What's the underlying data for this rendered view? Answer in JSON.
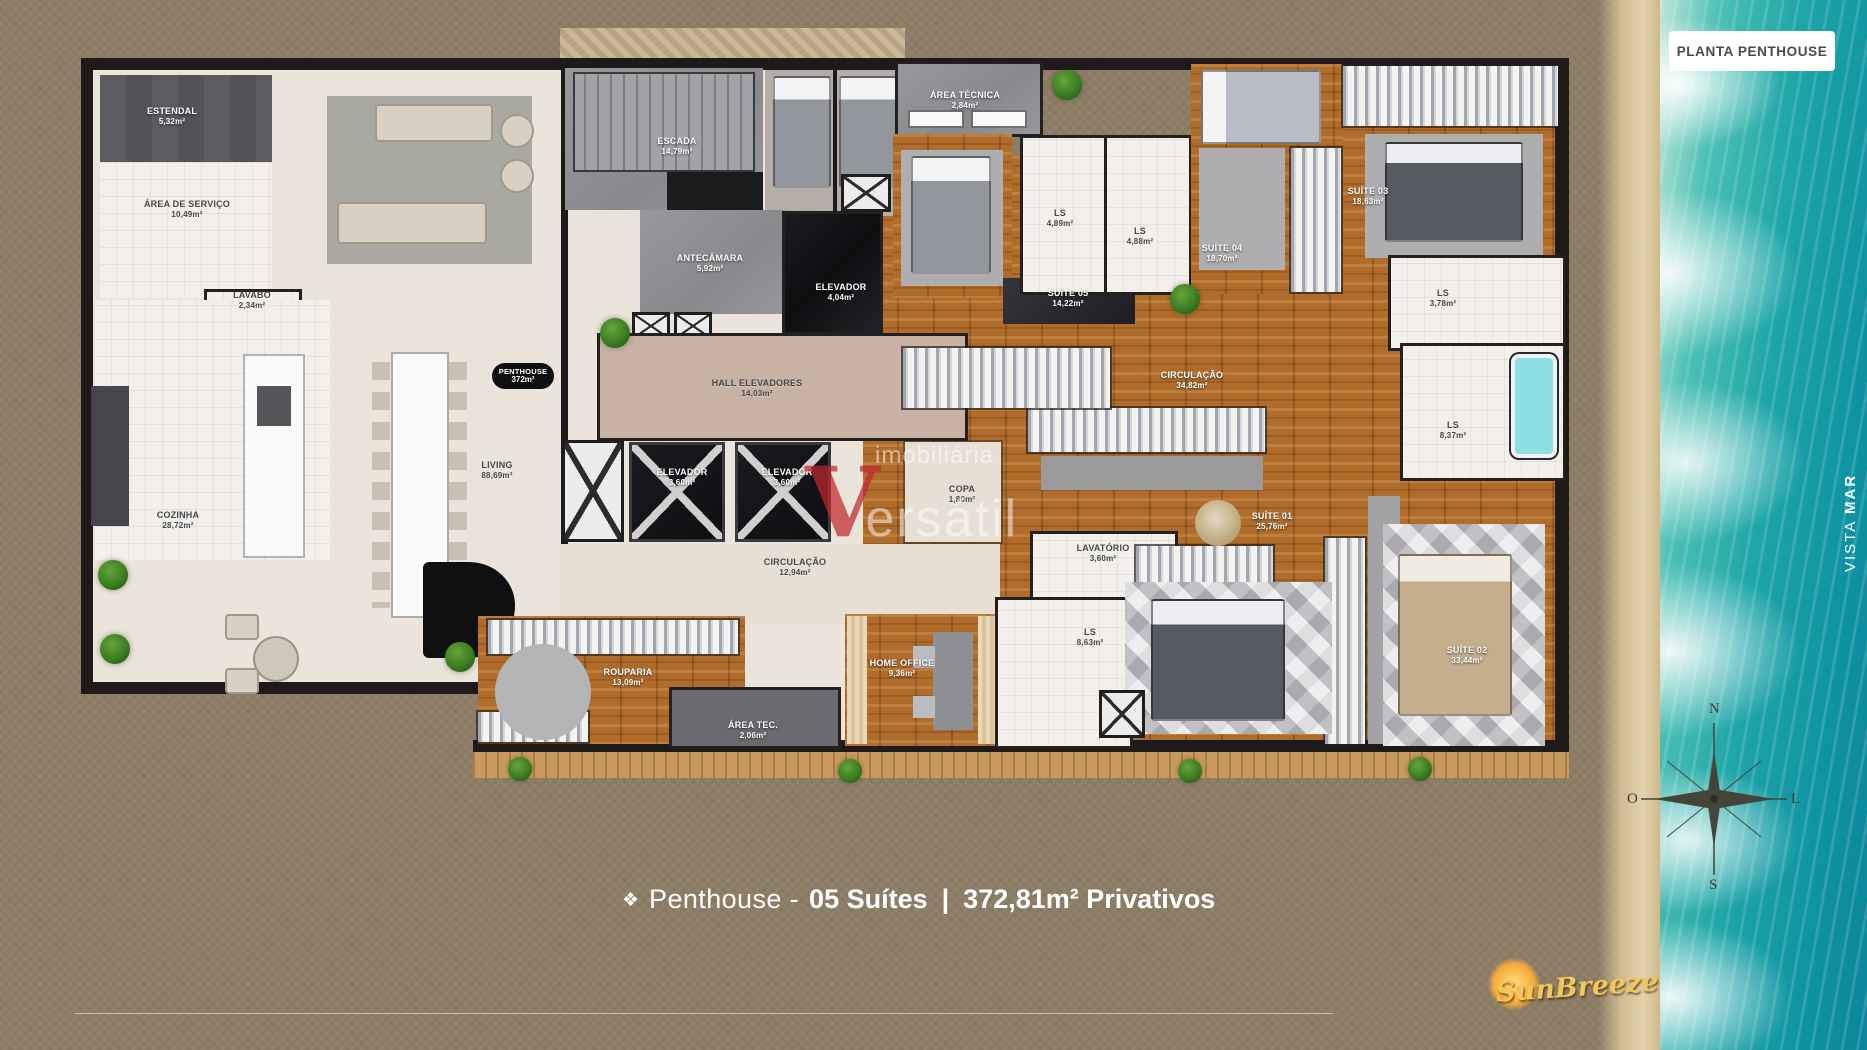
{
  "top_badge": {
    "label": "PLANTA PENTHOUSE"
  },
  "vista_mar": {
    "word1": "VISTA",
    "word2": "MAR",
    "color": "#0f9d99"
  },
  "caption": {
    "icon": "❖",
    "prefix": "Penthouse -",
    "suites": "05 Suítes",
    "separator": "|",
    "privative": "372,81m² Privativos"
  },
  "compass": {
    "north": "N",
    "south": "S",
    "west": "O",
    "east": "L"
  },
  "watermark": {
    "top": "imobiliária",
    "initial": "V",
    "rest": "ersátil"
  },
  "logo": {
    "text": "SunBreeze"
  },
  "colors": {
    "accent_teal": "#0f9d99",
    "background_brown": "#8d7d67",
    "wood_floor": "#b06c2b",
    "wall": "#1d1a19",
    "watermark_red": "#c1272d",
    "logo_gold": "#f2c75a"
  },
  "plan": {
    "overlay_badge": {
      "name": "PENTHOUSE",
      "area": "372m²"
    },
    "rooms": [
      {
        "name": "ESTENDAL",
        "area": "5,32m²",
        "x": 172,
        "y": 116,
        "tone": "light"
      },
      {
        "name": "ÁREA DE SERVIÇO",
        "area": "10,49m²",
        "x": 187,
        "y": 209,
        "tone": "dark"
      },
      {
        "name": "LAVABO",
        "area": "2,34m²",
        "x": 252,
        "y": 300,
        "tone": "dark"
      },
      {
        "name": "COZINHA",
        "area": "28,72m²",
        "x": 178,
        "y": 520,
        "tone": "dark"
      },
      {
        "name": "LIVING",
        "area": "88,69m²",
        "x": 497,
        "y": 470,
        "tone": "dark"
      },
      {
        "name": "ESCADA",
        "area": "14,79m²",
        "x": 677,
        "y": 146,
        "tone": "light"
      },
      {
        "name": "ANTECÂMARA",
        "area": "5,92m²",
        "x": 710,
        "y": 263,
        "tone": "light"
      },
      {
        "name": "ELEVADOR",
        "area": "4,04m²",
        "x": 841,
        "y": 292,
        "tone": "light"
      },
      {
        "name": "HALL ELEVADORES",
        "area": "14,03m²",
        "x": 757,
        "y": 388,
        "tone": "dark"
      },
      {
        "name": "ELEVADOR",
        "area": "3,60m²",
        "x": 682,
        "y": 477,
        "tone": "light"
      },
      {
        "name": "ELEVADOR",
        "area": "3,60m²",
        "x": 787,
        "y": 477,
        "tone": "light"
      },
      {
        "name": "CIRCULAÇÃO",
        "area": "12,94m²",
        "x": 795,
        "y": 567,
        "tone": "dark"
      },
      {
        "name": "ROUPARIA",
        "area": "13,09m²",
        "x": 628,
        "y": 677,
        "tone": "light"
      },
      {
        "name": "ÁREA TEC.",
        "area": "2,06m²",
        "x": 753,
        "y": 730,
        "tone": "light"
      },
      {
        "name": "HOME OFFICE",
        "area": "9,36m²",
        "x": 902,
        "y": 668,
        "tone": "light"
      },
      {
        "name": "COPA",
        "area": "1,80m²",
        "x": 962,
        "y": 494,
        "tone": "dark"
      },
      {
        "name": "LAVATÓRIO",
        "area": "3,60m²",
        "x": 1103,
        "y": 553,
        "tone": "dark"
      },
      {
        "name": "LS",
        "area": "8,63m²",
        "x": 1090,
        "y": 637,
        "tone": "dark"
      },
      {
        "name": "ÁREA TÉCNICA",
        "area": "2,84m²",
        "x": 965,
        "y": 100,
        "tone": "light"
      },
      {
        "name": "SUÍTE 05",
        "area": "14,22m²",
        "x": 1068,
        "y": 298,
        "tone": "light"
      },
      {
        "name": "LS",
        "area": "4,89m²",
        "x": 1060,
        "y": 218,
        "tone": "dark"
      },
      {
        "name": "LS",
        "area": "4,88m²",
        "x": 1140,
        "y": 236,
        "tone": "dark"
      },
      {
        "name": "SUÍTE 04",
        "area": "18,70m²",
        "x": 1222,
        "y": 253,
        "tone": "light"
      },
      {
        "name": "CIRCULAÇÃO",
        "area": "34,82m²",
        "x": 1192,
        "y": 380,
        "tone": "light"
      },
      {
        "name": "SUÍTE 03",
        "area": "18,63m²",
        "x": 1368,
        "y": 196,
        "tone": "light"
      },
      {
        "name": "LS",
        "area": "3,78m²",
        "x": 1443,
        "y": 298,
        "tone": "dark"
      },
      {
        "name": "LS",
        "area": "8,37m²",
        "x": 1453,
        "y": 430,
        "tone": "dark"
      },
      {
        "name": "SUÍTE 01",
        "area": "25,76m²",
        "x": 1272,
        "y": 521,
        "tone": "light"
      },
      {
        "name": "SUÍTE 02",
        "area": "33,44m²",
        "x": 1467,
        "y": 655,
        "tone": "light"
      }
    ]
  }
}
